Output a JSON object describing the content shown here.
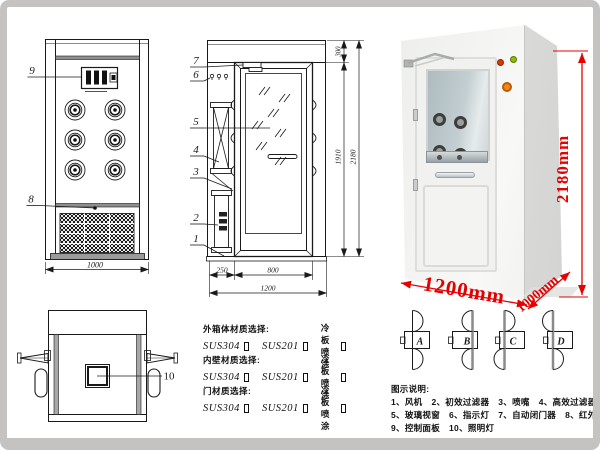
{
  "front_view": {
    "panel_label": "9",
    "grille_label": "8",
    "width_dim": "1000"
  },
  "side_view": {
    "labels": [
      "7",
      "6",
      "5",
      "4",
      "3",
      "2",
      "1"
    ],
    "dims": {
      "top": "300",
      "door_height": "1910",
      "total_height": "2180",
      "left": "250",
      "door_width": "800",
      "total_width": "1200"
    }
  },
  "top_view": {
    "lamp_label": "10"
  },
  "photo": {
    "height": "2180mm",
    "width": "1200mm",
    "depth": "1000mm",
    "dim_color": "#e60000"
  },
  "door_configs": {
    "labels": [
      "A",
      "B",
      "C",
      "D"
    ]
  },
  "materials": {
    "sections": [
      {
        "title": "外箱体材质选择:",
        "options": [
          "SUS304",
          "SUS201",
          "冷板喷涂"
        ]
      },
      {
        "title": "内壁材质选择:",
        "options": [
          "SUS304",
          "SUS201",
          "冷板喷涂"
        ]
      },
      {
        "title": "门材质选择:",
        "options": [
          "SUS304",
          "SUS201",
          "冷板喷涂"
        ]
      }
    ]
  },
  "legend": {
    "title": "图示说明:",
    "rows": [
      [
        "1、风机",
        "2、初效过滤器",
        "3、喷嘴",
        "4、高效过滤器"
      ],
      [
        "5、玻璃视窗",
        "6、指示灯",
        "7、自动闭门器",
        "8、红外线感应器"
      ],
      [
        "9、控制面板",
        "10、照明灯"
      ]
    ]
  }
}
